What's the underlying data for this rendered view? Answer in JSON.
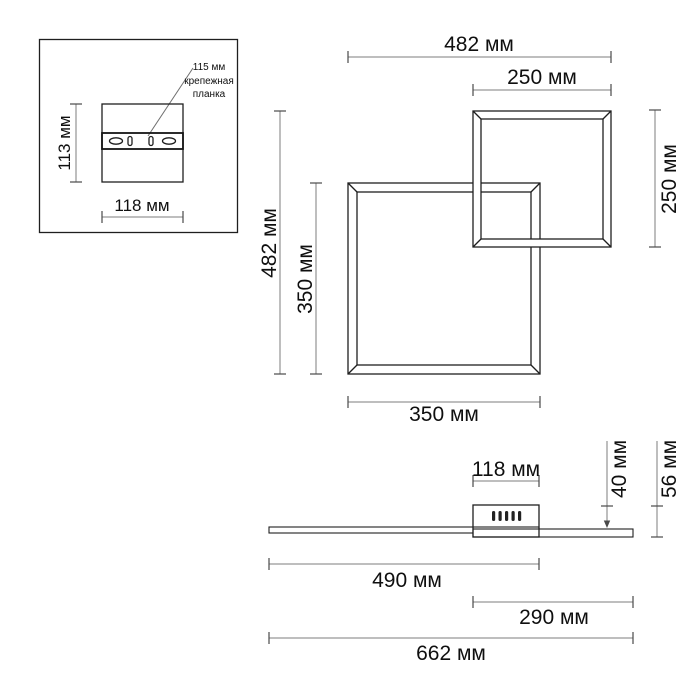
{
  "title": "Ceiling light fixture dimensional drawing",
  "units": "мм",
  "colors": {
    "background": "#ffffff",
    "geometry_line": "#1f1f1f",
    "dimension_line": "#7d7d7d",
    "text": "#0f0f0f"
  },
  "inset": {
    "callout": {
      "line1": "115 мм",
      "line2": "крепежная",
      "line3": "планка"
    },
    "dim_plate_height": "113 мм",
    "dim_plate_width": "118 мм"
  },
  "front_view": {
    "dim_top_total_width": "482 мм",
    "dim_small_square_width": "250 мм",
    "dim_left_total_height": "482 мм",
    "dim_large_square_height": "350 мм",
    "dim_small_square_height": "250 мм",
    "dim_large_square_width": "350 мм"
  },
  "side_view": {
    "dim_canopy_width": "118 мм",
    "dim_canopy_height": "40 мм",
    "dim_total_height": "56 мм",
    "dim_left_span": "490 мм",
    "dim_right_span": "290 мм",
    "dim_total_width": "662 мм"
  }
}
